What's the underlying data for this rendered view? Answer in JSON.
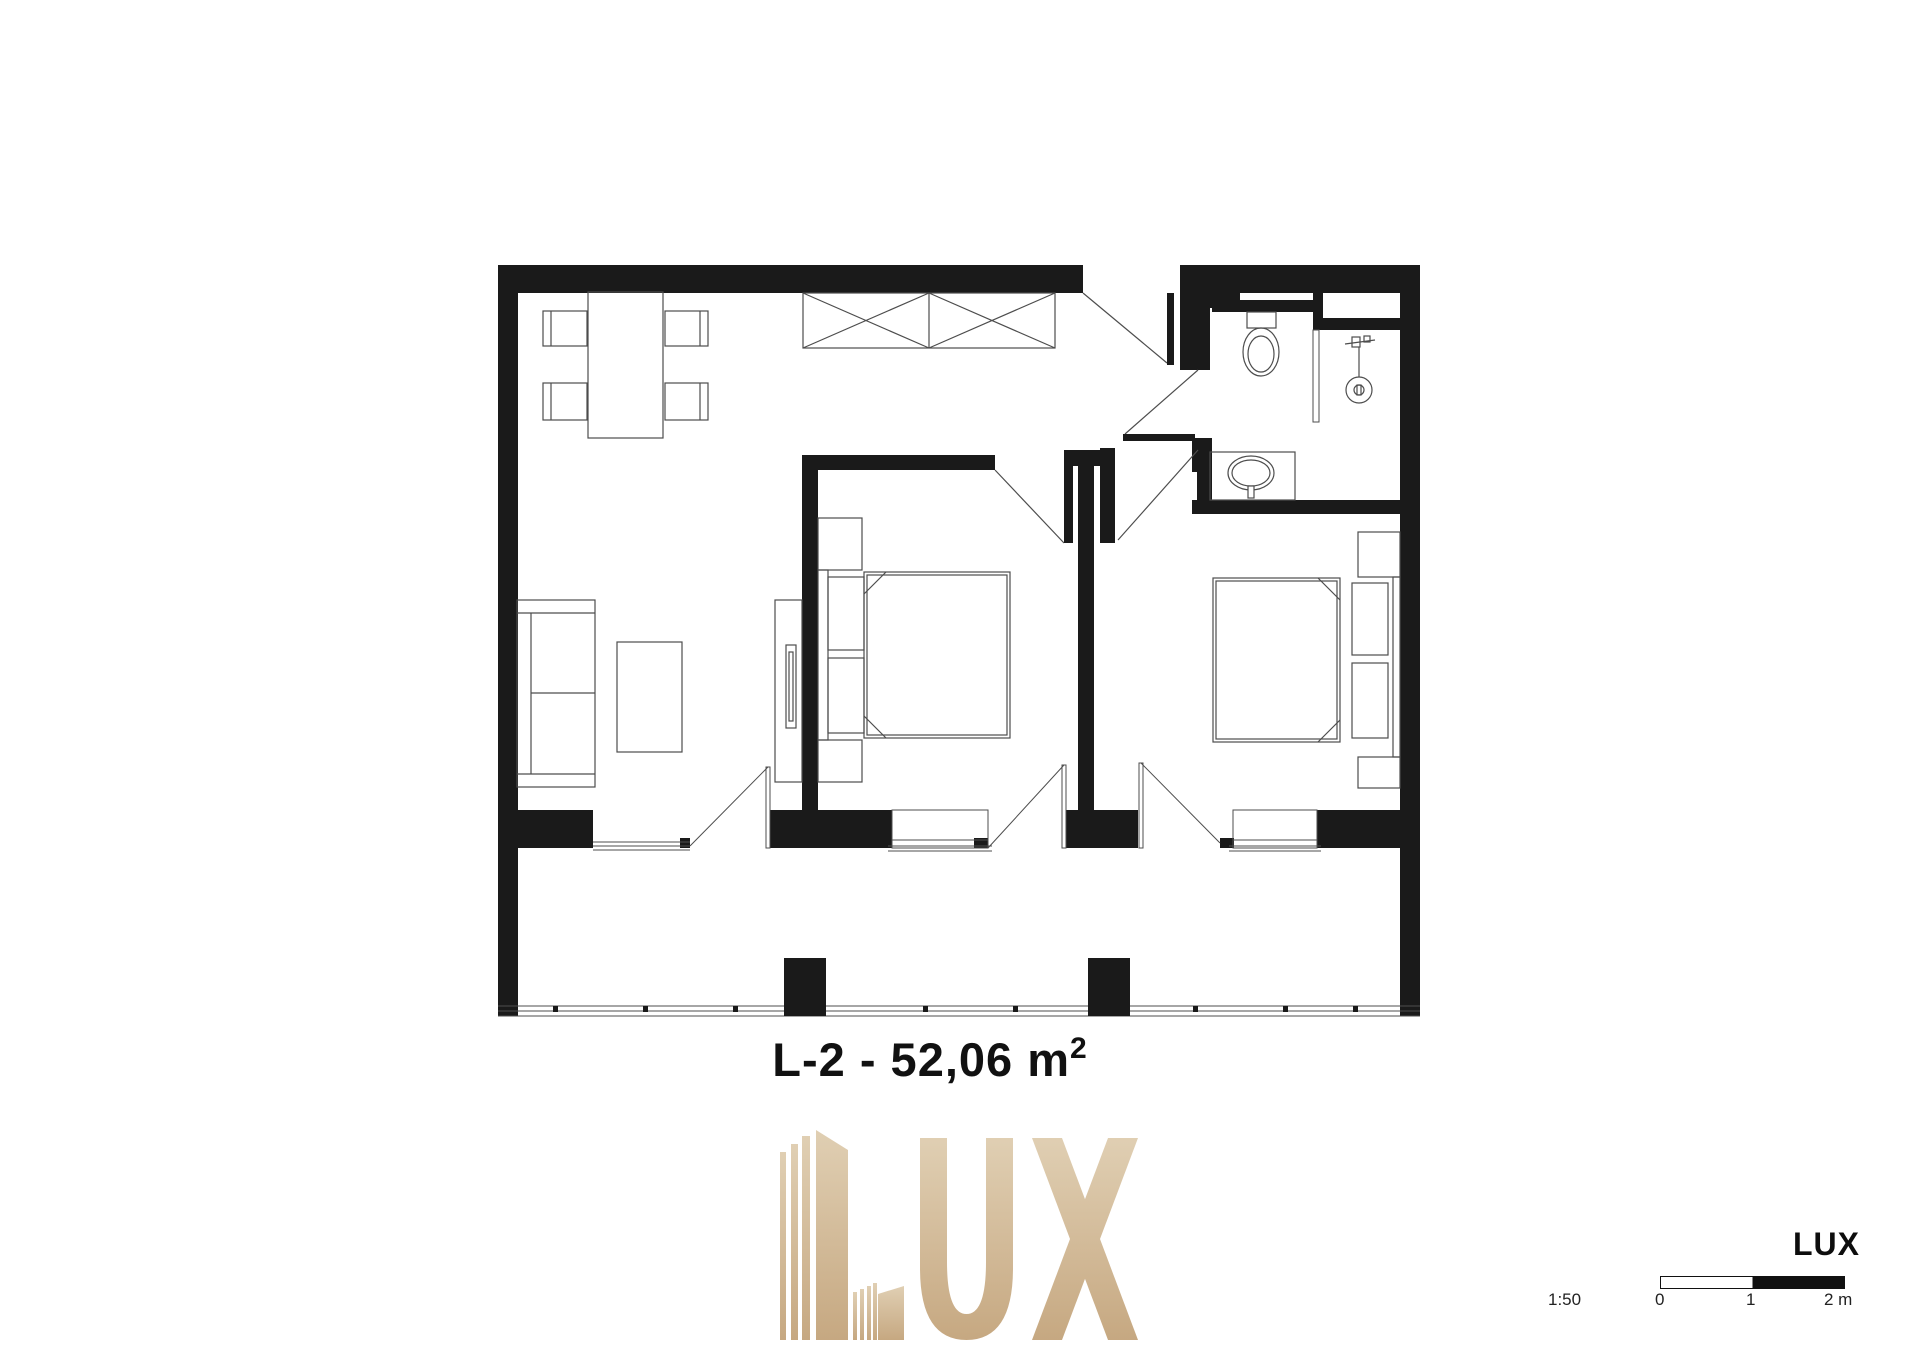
{
  "page": {
    "background": "#ffffff"
  },
  "floorplan": {
    "title": {
      "main": "L-2 - 52,06 m",
      "sup": "2"
    },
    "wall_color": "#1a1a1a",
    "line_color": "#4d4d4d",
    "rooms": [
      "living-dining-room",
      "bedroom-1",
      "bedroom-2",
      "bathroom",
      "hallway",
      "balcony"
    ],
    "furniture_icons": [
      "dining-table-icon",
      "dining-chair-icon",
      "wardrobe-icon",
      "sofa-icon",
      "coffee-table-icon",
      "tv-unit-icon",
      "double-bed-icon",
      "nightstand-icon",
      "toilet-icon",
      "shower-icon",
      "washbasin-icon",
      "entrance-door-icon",
      "interior-door-icon",
      "window-icon",
      "balcony-railing-icon"
    ]
  },
  "watermark": {
    "text": "LUX",
    "gradient_top": "#e0cfb3",
    "gradient_bottom": "#c6a881"
  },
  "scalebar": {
    "brand": "LUX",
    "ratio": "1:50",
    "ticks": [
      "0",
      "1",
      "2 m"
    ],
    "bar_color": "#111111"
  }
}
